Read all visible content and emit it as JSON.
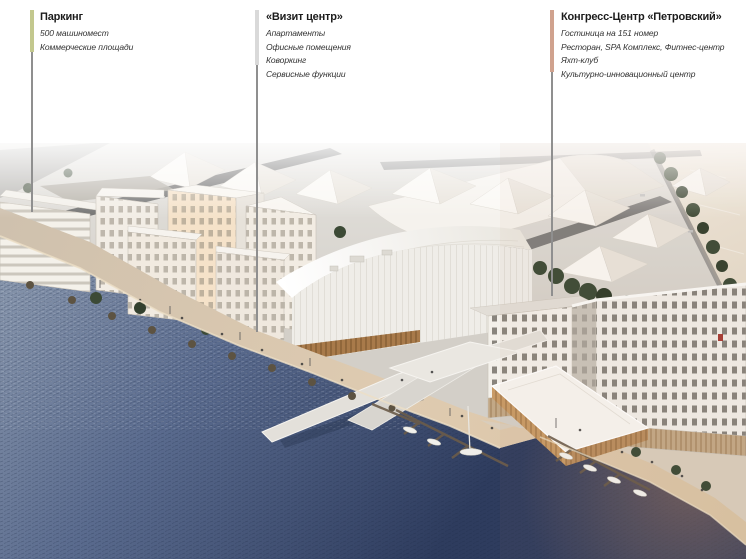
{
  "annotations": [
    {
      "title": "Паркинг",
      "lines": [
        "500 машиномест",
        "Коммерческие площади"
      ],
      "accent_color": "#c3c88e"
    },
    {
      "title": "«Визит центр»",
      "lines": [
        "Апартаменты",
        "Офисные помещения",
        "Коворкинг",
        "Сервисные функции"
      ],
      "accent_color": "#d9d9d9"
    },
    {
      "title": "Конгресс-Центр «Петровский»",
      "lines": [
        "Гостиница на 151 номер",
        "Ресторан, SPA Комплекс, Фитнес-центр",
        "Яхт-клуб",
        "Культурно-инновационный центр"
      ],
      "accent_color": "#d0a28e"
    }
  ],
  "scene": {
    "colors": {
      "leader_stem": "#8f8f8f",
      "ground": "#d8d5d0",
      "road": "#606060",
      "building_light": "#f4f1ea",
      "building_shade": "#e7e2da",
      "sunlit_facade": "#f5e2c9",
      "hall_roof_light": "#ffffff",
      "hall_roof_dark": "#e9e6df",
      "wood_base": "#a87a4a",
      "promenade": "#dfcbb0",
      "promenade_far": "#cfc1ae",
      "water_near": "#8b99ae",
      "water_mid": "#5a6b8e",
      "water_deep": "#2e3c5e",
      "water_sunlit": "#f0eadf",
      "water_sunlit_far": "#e2d8c6",
      "glint": "#b5805c",
      "trees": "#3c4a36",
      "hotel_facade": "#f1eee8"
    }
  }
}
